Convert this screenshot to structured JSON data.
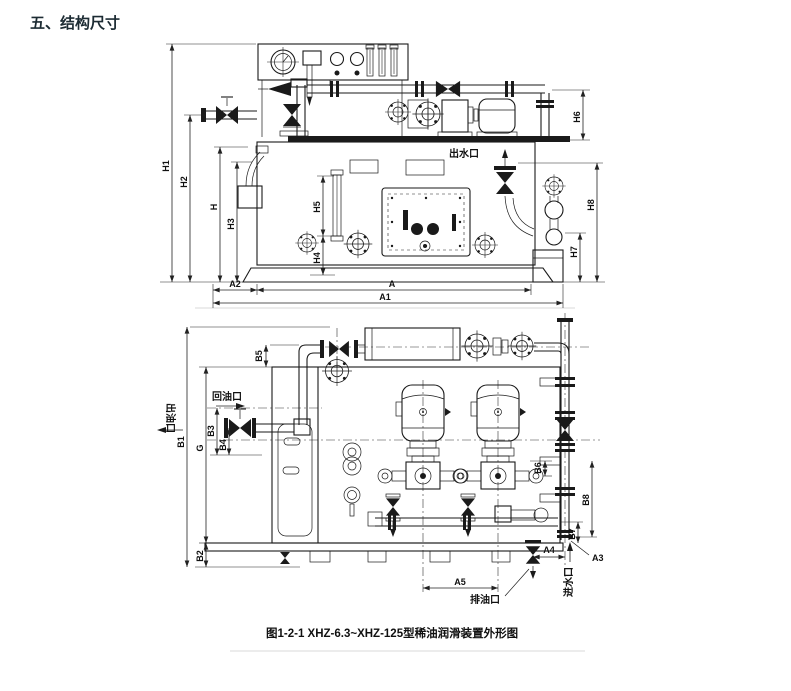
{
  "page": {
    "title": "五、结构尺寸",
    "caption": "图1-2-1  XHZ-6.3~XHZ-125型稀油润滑装置外形图",
    "title_color": "#1c2b33",
    "line_color": "#1a1a1a",
    "paper_color": "#ffffff"
  },
  "front_view": {
    "dims": {
      "h1": "H1",
      "h2": "H2",
      "h": "H",
      "h3": "H3",
      "h4": "H4",
      "h5": "H5",
      "h6": "H6",
      "h7": "H7",
      "h8": "H8",
      "a": "A",
      "a1": "A1",
      "a2": "A2"
    },
    "ports": {
      "water_outlet": "出水口"
    }
  },
  "plan_view": {
    "dims": {
      "b1": "B1",
      "b2": "B2",
      "b3": "B3",
      "b4": "B4",
      "b5": "B5",
      "b6": "B6",
      "b7": "B7",
      "b8": "B8",
      "g": "G",
      "a3": "A3",
      "a4": "A4",
      "a5": "A5"
    },
    "ports": {
      "oil_return": "回油口",
      "oil_outlet": "出油口",
      "oil_drain": "排油口",
      "water_inlet": "进水口"
    }
  }
}
